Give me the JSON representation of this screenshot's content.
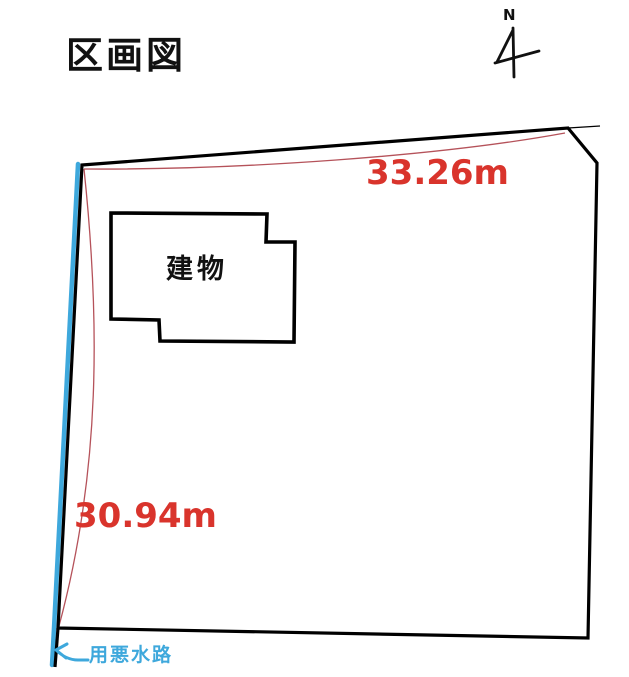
{
  "title": "区画図",
  "compass": {
    "label": "N"
  },
  "diagram": {
    "building_label": "建物",
    "waterway_label": "用悪水路",
    "measurements": {
      "top_edge": "33.26m",
      "left_edge": "30.94m"
    }
  },
  "colors": {
    "outline": "#000000",
    "measurement_text": "#d9342c",
    "measurement_line": "#b5525a",
    "waterway": "#3ea8dc"
  }
}
